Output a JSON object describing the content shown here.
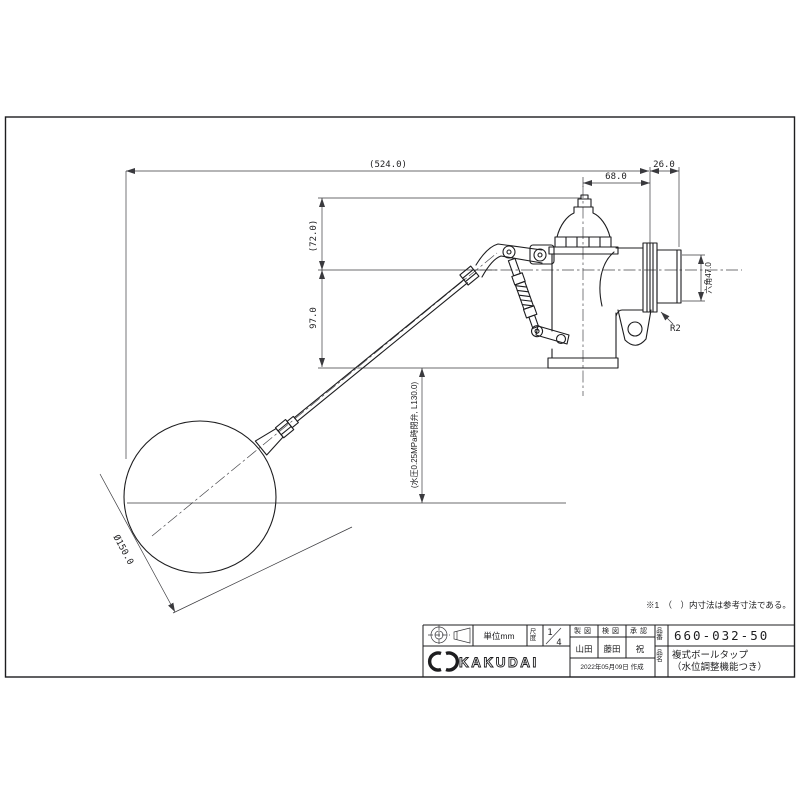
{
  "drawing": {
    "note": "※1　（　）内寸法は参考寸法である。",
    "dimensions": {
      "overall_length": "(524.0)",
      "thread_length": "26.0",
      "outlet_offset": "68.0",
      "cap_height": "(72.0)",
      "body_drop": "97.0",
      "closing_level": "(水圧0.25MPa時閉弁, L130.0)",
      "float_diameter": "Ø150.0",
      "hex_width": "六角47.0",
      "thread_spec": "R2"
    }
  },
  "title_block": {
    "unit_label": "単位mm",
    "scale_label": "尺度",
    "scale_numerator": "1",
    "scale_denominator": "4",
    "brand": "KAKUDAI",
    "drafted_label": "製図",
    "checked_label": "検図",
    "approved_label": "承認",
    "drafted_by": "山田",
    "checked_by": "藤田",
    "approved_by": "祝",
    "date": "2022年05月09日 作成",
    "part_no_label": "品番",
    "part_no": "660-032-50",
    "product_name_label": "品名",
    "product_name_line1": "複式ボールタップ",
    "product_name_line2": "（水位調整機能つき）"
  }
}
